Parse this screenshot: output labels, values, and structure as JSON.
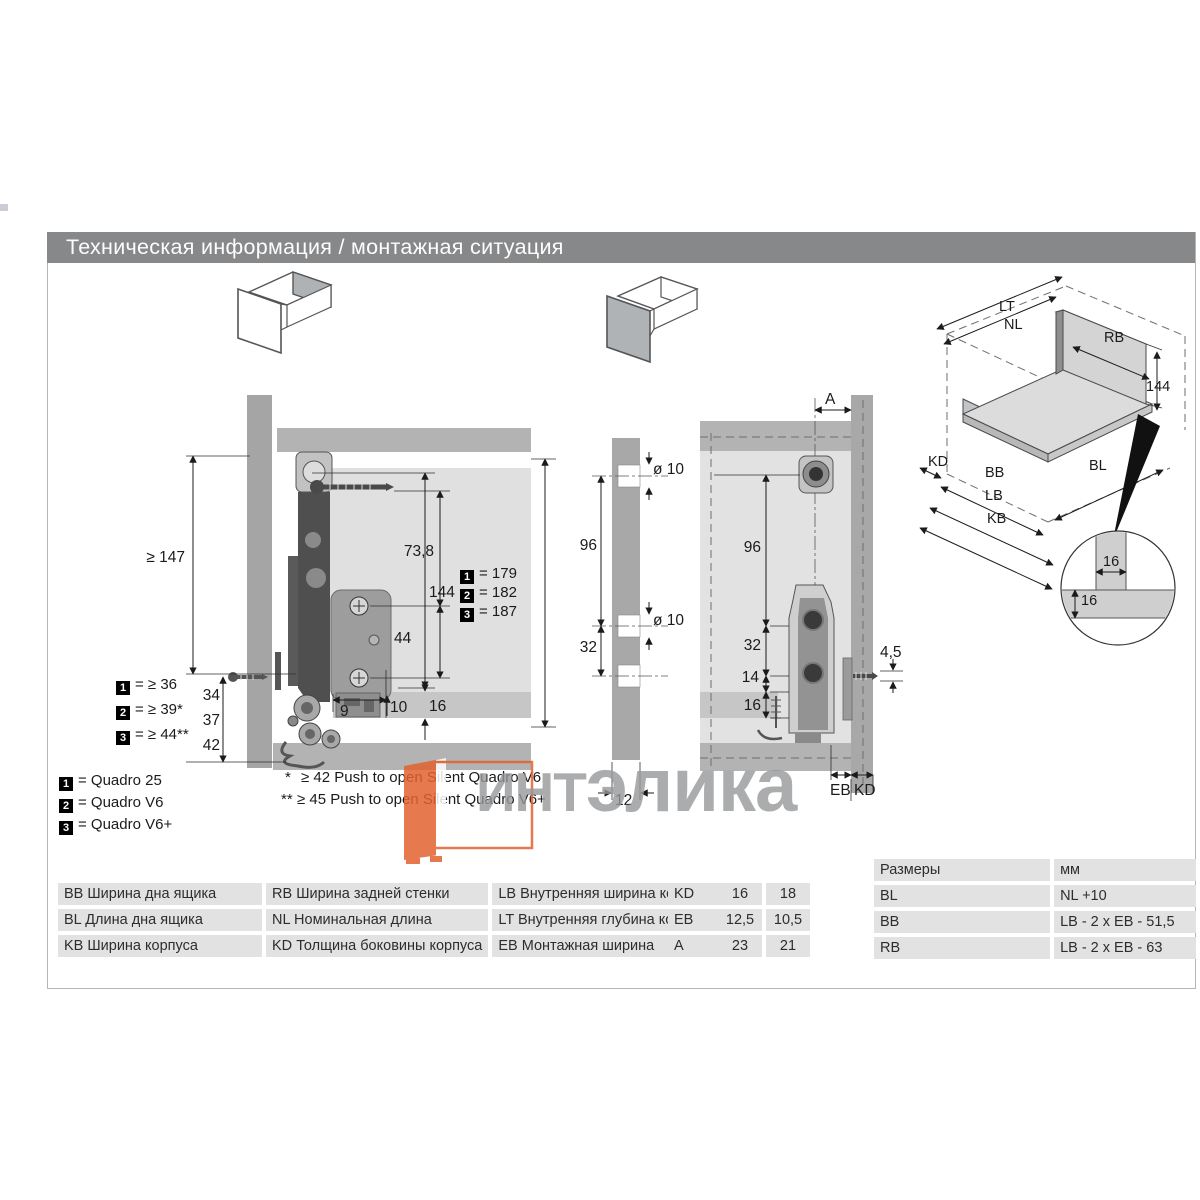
{
  "page": {
    "title": "Техническая информация / монтажная ситуация"
  },
  "watermark": {
    "part1": "ИНТ",
    "part2": "элика",
    "orange": "#e2622e",
    "gray": "#97989a"
  },
  "quadro_legend": {
    "items": [
      {
        "badge": "1",
        "label": "= Quadro 25"
      },
      {
        "badge": "2",
        "label": "= Quadro V6"
      },
      {
        "badge": "3",
        "label": "= Quadro V6+"
      }
    ]
  },
  "footnotes": {
    "items": [
      {
        "marker": "*",
        "text": "≥ 42 Push to open Silent Quadro V6"
      },
      {
        "marker": "**",
        "text": "≥ 45 Push to open Silent Quadro V6+"
      }
    ]
  },
  "left_diagram": {
    "dims": {
      "min_height": "≥ 147",
      "screw_offset": "73,8",
      "side_height": "144",
      "hole_pitch": "44",
      "alt_34": "34",
      "alt_37": "37",
      "alt_42": "42",
      "offset_9": "9",
      "offset_10": "10",
      "bottom_thickness": "16"
    },
    "height_variants": [
      {
        "badge": "1",
        "value": "= 179"
      },
      {
        "badge": "2",
        "value": "= 182"
      },
      {
        "badge": "3",
        "value": "= 187"
      }
    ],
    "gap_variants": [
      {
        "badge": "1",
        "value": "= ≥ 36"
      },
      {
        "badge": "2",
        "value": "= ≥ 39*"
      },
      {
        "badge": "3",
        "value": "= ≥ 44**"
      }
    ]
  },
  "middle_diagram": {
    "dims": {
      "hole_dia_top": "ø 10",
      "hole_dia_mid": "ø 10",
      "pitch_96": "96",
      "pitch_32": "32",
      "panel_width": "12"
    }
  },
  "right_diagram": {
    "dims": {
      "a": "A",
      "pitch_96": "96",
      "pitch_32": "32",
      "offset_14": "14",
      "bottom_16": "16",
      "plate_45": "4,5",
      "eb": "EB",
      "kd": "KD"
    }
  },
  "iso_diagram": {
    "labels": {
      "lt": "LT",
      "nl": "NL",
      "rb": "RB",
      "height": "144",
      "kd": "KD",
      "bb": "BB",
      "lb": "LB",
      "kb": "KB",
      "bl": "BL"
    },
    "detail": {
      "h": "16",
      "v": "16"
    }
  },
  "legend_table": {
    "rows": [
      [
        {
          "code": "BB",
          "desc": "Ширина дна ящика"
        },
        {
          "code": "RB",
          "desc": "Ширина задней стенки"
        },
        {
          "code": "LB",
          "desc": "Внутренняя ширина корпуса"
        }
      ],
      [
        {
          "code": "BL",
          "desc": "Длина дна ящика"
        },
        {
          "code": "NL",
          "desc": "Номинальная длина"
        },
        {
          "code": "LT",
          "desc": "Внутренняя глубина корпуса"
        }
      ],
      [
        {
          "code": "KB",
          "desc": "Ширина корпуса"
        },
        {
          "code": "KD",
          "desc": "Толщина боковины корпуса"
        },
        {
          "code": "EB",
          "desc": "Монтажная ширина"
        }
      ]
    ]
  },
  "params_table": {
    "rows": [
      [
        "KD",
        "16",
        "18"
      ],
      [
        "EB",
        "12,5",
        "10,5"
      ],
      [
        "A",
        "23",
        "21"
      ]
    ]
  },
  "size_table": {
    "header": [
      "Размеры",
      "мм"
    ],
    "rows": [
      [
        "BL",
        "NL +10"
      ],
      [
        "BB",
        "LB - 2 x EB - 51,5"
      ],
      [
        "RB",
        "LB - 2 x EB - 63"
      ]
    ]
  }
}
